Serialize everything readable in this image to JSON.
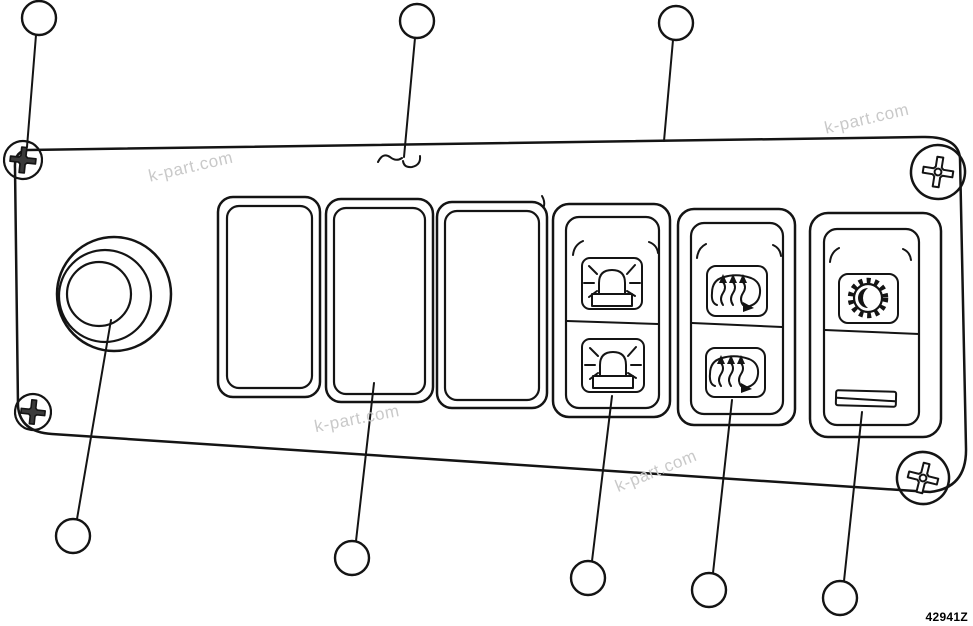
{
  "diagram": {
    "part_number": "42941Z",
    "watermark_text": "k-part.com",
    "watermarks": [
      {
        "x": 192,
        "y": 172,
        "angle": -13
      },
      {
        "x": 868,
        "y": 124,
        "angle": -13
      },
      {
        "x": 358,
        "y": 424,
        "angle": -11
      },
      {
        "x": 658,
        "y": 476,
        "angle": -22
      }
    ],
    "callouts": [
      {
        "id": "callout-top-left-screw",
        "cx": 39,
        "cy": 18,
        "line": [
          36,
          35,
          27,
          147
        ]
      },
      {
        "id": "callout-panel-surface",
        "cx": 417,
        "cy": 21,
        "line": [
          415,
          38,
          404,
          157
        ]
      },
      {
        "id": "callout-panel-top-edge",
        "cx": 676,
        "cy": 23,
        "line": [
          673,
          40,
          664,
          141
        ]
      },
      {
        "id": "callout-knob",
        "cx": 73,
        "cy": 536,
        "line": [
          111,
          320,
          77,
          519
        ]
      },
      {
        "id": "callout-blank-switch",
        "cx": 352,
        "cy": 558,
        "line": [
          374,
          383,
          356,
          541
        ]
      },
      {
        "id": "callout-beacon-switch",
        "cx": 588,
        "cy": 578,
        "line": [
          612,
          396,
          592,
          561
        ]
      },
      {
        "id": "callout-heater-switch",
        "cx": 709,
        "cy": 590,
        "line": [
          732,
          400,
          713,
          573
        ]
      },
      {
        "id": "callout-dimmer-switch",
        "cx": 840,
        "cy": 598,
        "line": [
          862,
          412,
          844,
          581
        ]
      }
    ],
    "components": {
      "panel": "switch panel",
      "knob": "round knob",
      "switches": [
        "blank rocker",
        "blank rocker",
        "blank rocker",
        "beacon light rocker",
        "heated mirror rocker",
        "panel light dimmer rocker"
      ],
      "screws": [
        "top-left",
        "top-right",
        "bottom-left",
        "bottom-right"
      ]
    },
    "colors": {
      "line": "#141414",
      "watermark": "#c9c9c9",
      "background": "#ffffff"
    }
  }
}
